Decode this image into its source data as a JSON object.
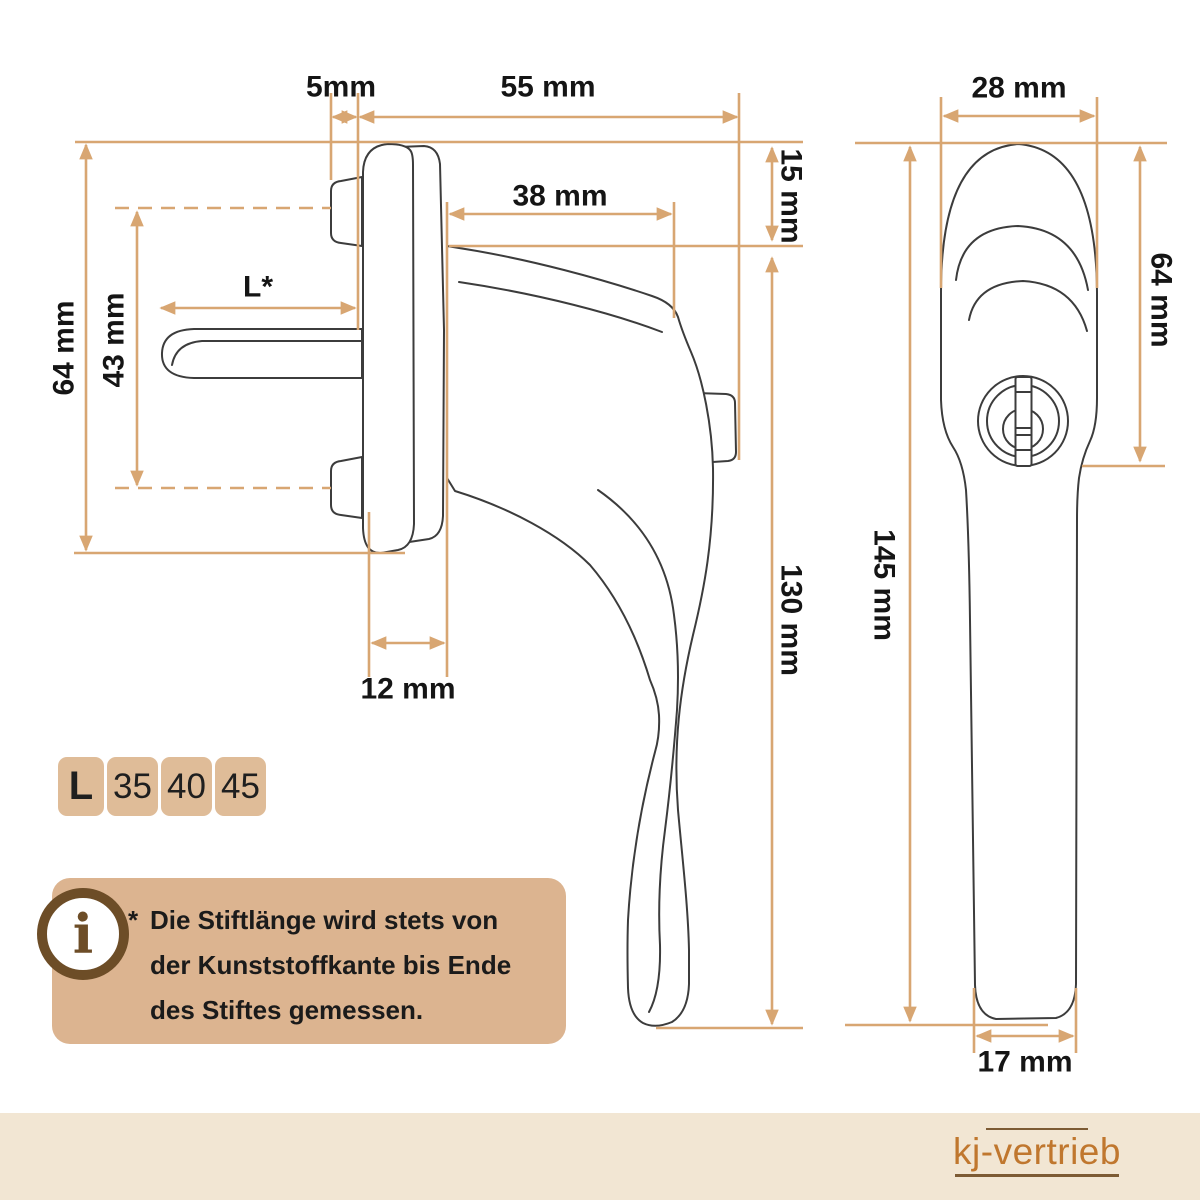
{
  "colors": {
    "dimension_lines": "#d8a672",
    "drawing_outline": "#3c3c3c",
    "label_text": "#151515",
    "table_panel": "#dfbc98",
    "info_panel": "#dcb490",
    "info_icon_brown": "#6d4d27",
    "footer_strip": "#f2e6d3",
    "brand_text": "#c0772e",
    "brand_rules": "#7d5b34"
  },
  "front_view": {
    "dims": {
      "pin_offset": "5mm",
      "total_depth": "55 mm",
      "grip_depth": "38 mm",
      "cap_height": "15 mm",
      "lever_height": "130 mm",
      "rosette_height": "64 mm",
      "screw_spacing": "43 mm",
      "pin_length": "L*",
      "base_depth": "12 mm"
    }
  },
  "side_view": {
    "dims": {
      "head_width": "28 mm",
      "head_height": "64 mm",
      "total_height": "145 mm",
      "lever_width": "17 mm"
    }
  },
  "length_table": {
    "header": "L",
    "options": [
      "35",
      "40",
      "45"
    ]
  },
  "info_note": {
    "marker": "*",
    "lines": [
      "Die Stiftlänge wird stets von",
      "der Kunststoffkante bis Ende",
      "des Stiftes gemessen."
    ]
  },
  "footer": {
    "brand": "kj-vertrieb"
  }
}
